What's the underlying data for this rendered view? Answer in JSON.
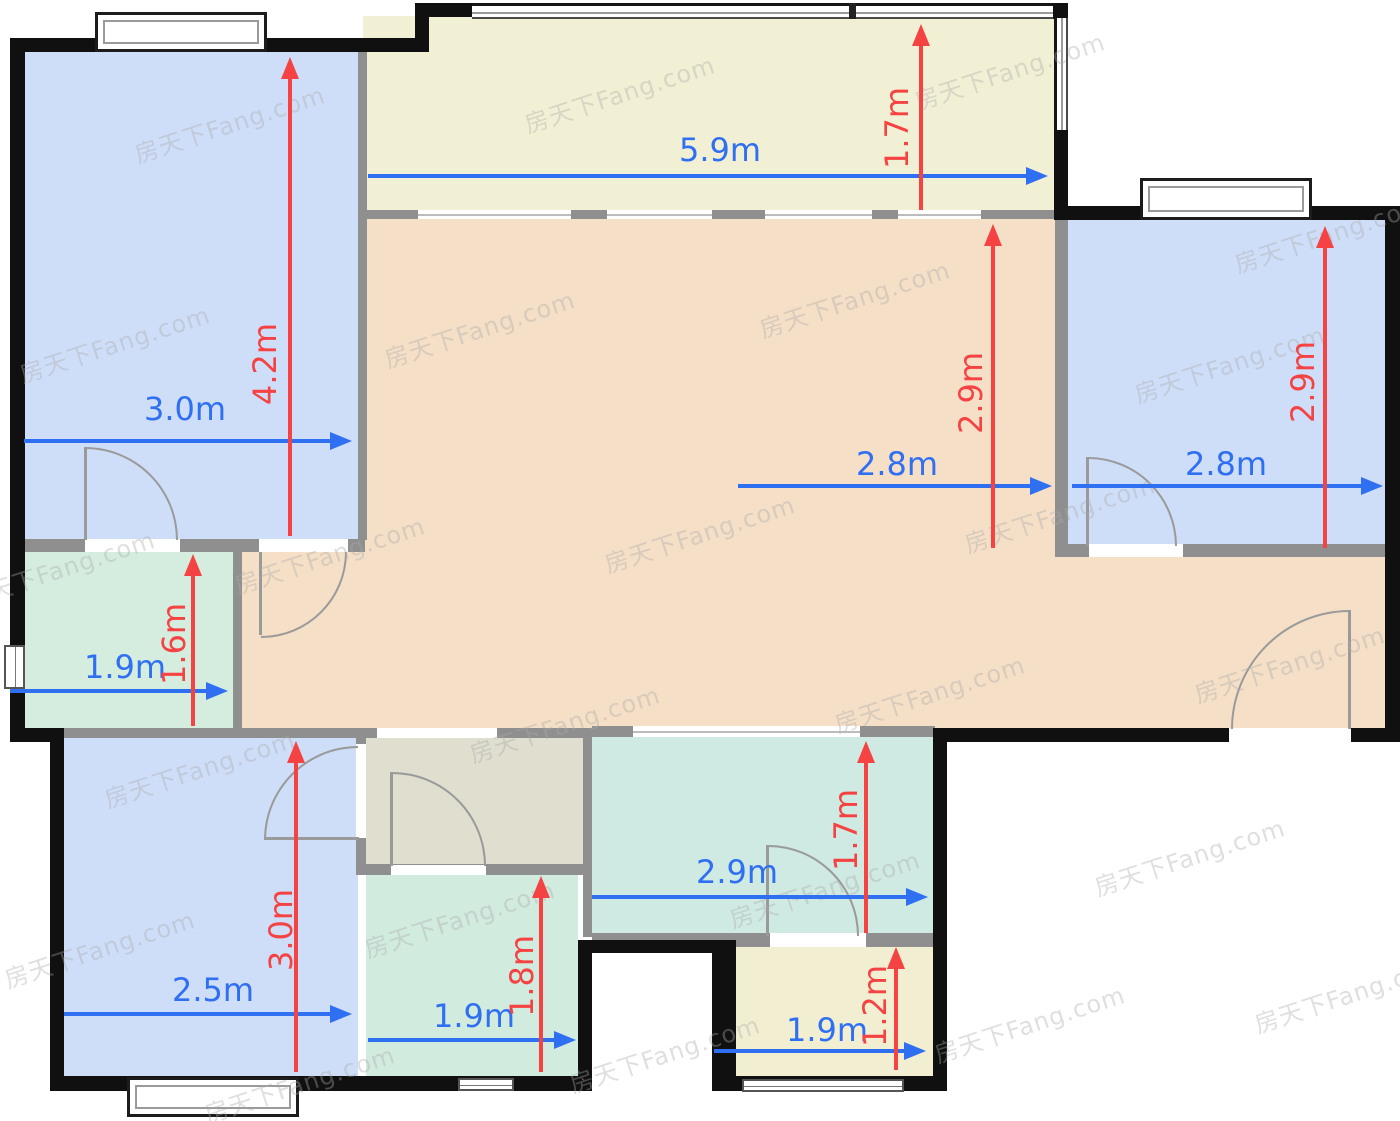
{
  "watermark": {
    "text": "房天下Fang.com"
  },
  "colors": {
    "wall_outer": "#101010",
    "wall_inner": "#8f8f8f",
    "arrow_blue": "#2f6ff2",
    "arrow_red": "#f54242",
    "door_line": "#9a9a9a",
    "room_blue": "#cfdef8",
    "room_peach": "#f5dfc7",
    "room_cream": "#f2f0d4",
    "room_cream2": "#f2eed2",
    "room_mint": "#d5eddf",
    "room_mint2": "#d2ebdf",
    "room_teal": "#cfe9e3",
    "room_olive": "#dfdecf"
  },
  "plan": {
    "rooms": [
      {
        "name": "bedroom-top-left",
        "color": "room_blue",
        "rect": [
          25,
          52,
          333,
          488
        ]
      },
      {
        "name": "balcony",
        "color": "room_cream",
        "rect": [
          363,
          16,
          692,
          196
        ]
      },
      {
        "name": "living-dining",
        "color": "room_peach",
        "rect": [
          365,
          219,
          690,
          512
        ]
      },
      {
        "name": "hall-left",
        "color": "room_peach",
        "rect": [
          242,
          552,
          123,
          181
        ]
      },
      {
        "name": "hall-entry",
        "color": "room_peach",
        "rect": [
          1055,
          557,
          331,
          175
        ]
      },
      {
        "name": "bedroom-top-right",
        "color": "room_blue",
        "rect": [
          1068,
          220,
          317,
          325
        ]
      },
      {
        "name": "utility-left",
        "color": "room_mint",
        "rect": [
          25,
          552,
          208,
          178
        ]
      },
      {
        "name": "bedroom-bottom-left",
        "color": "room_blue",
        "rect": [
          64,
          738,
          294,
          340
        ]
      },
      {
        "name": "bath-lobby",
        "color": "room_olive",
        "rect": [
          366,
          738,
          217,
          128
        ]
      },
      {
        "name": "bathroom",
        "color": "room_mint2",
        "rect": [
          366,
          873,
          212,
          205
        ]
      },
      {
        "name": "kitchen",
        "color": "room_teal",
        "rect": [
          592,
          737,
          341,
          198
        ]
      },
      {
        "name": "store-bottom",
        "color": "room_cream2",
        "rect": [
          736,
          947,
          197,
          131
        ]
      }
    ],
    "walls_inner": [
      [
        20,
        539,
        345,
        13
      ],
      [
        233,
        552,
        9,
        178
      ],
      [
        358,
        52,
        9,
        488
      ],
      [
        363,
        210,
        692,
        9
      ],
      [
        1055,
        220,
        13,
        326
      ],
      [
        1055,
        544,
        330,
        13
      ],
      [
        50,
        728,
        317,
        10
      ],
      [
        363,
        728,
        229,
        10
      ],
      [
        592,
        726,
        343,
        11
      ],
      [
        356,
        737,
        10,
        137
      ],
      [
        356,
        864,
        236,
        11
      ],
      [
        583,
        737,
        9,
        200
      ],
      [
        592,
        933,
        343,
        14
      ]
    ],
    "walls_outer": [
      [
        10,
        38,
        15,
        704
      ],
      [
        10,
        38,
        419,
        14
      ],
      [
        415,
        3,
        14,
        49
      ],
      [
        415,
        3,
        62,
        14
      ],
      [
        1051,
        3,
        17,
        16
      ],
      [
        1054,
        126,
        14,
        94
      ],
      [
        1055,
        206,
        345,
        14
      ],
      [
        1385,
        206,
        15,
        536
      ],
      [
        935,
        728,
        465,
        14
      ],
      [
        933,
        728,
        14,
        362
      ],
      [
        712,
        1076,
        235,
        15
      ],
      [
        712,
        940,
        24,
        151
      ],
      [
        578,
        940,
        158,
        13
      ],
      [
        578,
        940,
        14,
        151
      ],
      [
        358,
        1076,
        234,
        15
      ],
      [
        50,
        1076,
        320,
        15
      ],
      [
        50,
        742,
        14,
        349
      ],
      [
        10,
        728,
        54,
        14
      ]
    ],
    "openings": [
      {
        "rect": [
          85,
          539,
          95,
          13
        ]
      },
      {
        "rect": [
          259,
          539,
          89,
          13
        ]
      },
      {
        "rect": [
          377,
          728,
          120,
          10
        ]
      },
      {
        "rect": [
          391,
          865,
          95,
          10
        ]
      },
      {
        "rect": [
          356,
          744,
          10,
          94
        ]
      },
      {
        "rect": [
          633,
          726,
          227,
          11
        ],
        "line": true
      },
      {
        "rect": [
          770,
          933,
          96,
          14
        ]
      },
      {
        "rect": [
          1229,
          728,
          122,
          14
        ]
      },
      {
        "rect": [
          1089,
          544,
          94,
          13
        ]
      },
      {
        "rect": [
          418,
          210,
          153,
          9
        ],
        "line": true
      },
      {
        "rect": [
          607,
          210,
          105,
          9
        ],
        "line": true
      },
      {
        "rect": [
          765,
          210,
          107,
          9
        ],
        "line": true
      },
      {
        "rect": [
          898,
          210,
          83,
          9
        ],
        "line": true
      }
    ],
    "windows": [
      {
        "type": "framed",
        "rect": [
          95,
          12,
          172,
          40
        ]
      },
      {
        "type": "framed",
        "rect": [
          1140,
          178,
          172,
          42
        ]
      },
      {
        "type": "framed",
        "rect": [
          127,
          1077,
          172,
          40
        ]
      },
      {
        "type": "strip",
        "rect": [
          458,
          1078,
          56,
          13
        ]
      },
      {
        "type": "strip",
        "rect": [
          742,
          1079,
          162,
          13
        ]
      },
      {
        "type": "stripv",
        "rect": [
          4,
          645,
          21,
          44
        ]
      },
      {
        "type": "glassh",
        "rect": [
          472,
          3,
          581,
          16
        ]
      },
      {
        "type": "glassv",
        "rect": [
          1054,
          18,
          14,
          112
        ]
      },
      {
        "type": "mull",
        "rect": [
          849,
          3,
          7,
          16
        ]
      }
    ],
    "doors": [
      {
        "name": "door-bedroom-tl-utility",
        "leaf": [
          84,
          447,
          3,
          93
        ],
        "cx": 85,
        "cy": 540,
        "r": 93,
        "quad": "ne"
      },
      {
        "name": "door-bedroom-tl",
        "leaf": [
          259,
          552,
          3,
          83
        ],
        "cx": 261,
        "cy": 552,
        "r": 86,
        "quad": "se"
      },
      {
        "name": "door-bathroom",
        "leaf": [
          390,
          772,
          3,
          94
        ],
        "cx": 392,
        "cy": 866,
        "r": 94,
        "quad": "ne"
      },
      {
        "name": "door-bedroom-bl",
        "leaf": [
          264,
          837,
          95,
          3
        ],
        "cx": 358,
        "cy": 840,
        "r": 94,
        "quad": "nw"
      },
      {
        "name": "door-store",
        "leaf": [
          766,
          845,
          3,
          91
        ],
        "cx": 768,
        "cy": 936,
        "r": 91,
        "quad": "ne"
      },
      {
        "name": "door-entrance",
        "leaf": [
          1348,
          610,
          3,
          119
        ],
        "cx": 1350,
        "cy": 729,
        "r": 119,
        "quad": "nw"
      },
      {
        "name": "door-bedroom-tr",
        "leaf": [
          1086,
          457,
          3,
          89
        ],
        "cx": 1088,
        "cy": 546,
        "r": 89,
        "quad": "ne"
      }
    ],
    "dims_h": [
      {
        "label": "3.0m",
        "x1": 24,
        "x2": 352,
        "y": 441,
        "lx": 185,
        "ly": 409
      },
      {
        "label": "5.9m",
        "x1": 368,
        "x2": 1048,
        "y": 176,
        "lx": 720,
        "ly": 150
      },
      {
        "label": "2.8m",
        "x1": 738,
        "x2": 1052,
        "y": 486,
        "lx": 897,
        "ly": 464
      },
      {
        "label": "2.8m",
        "x1": 1072,
        "x2": 1383,
        "y": 486,
        "lx": 1226,
        "ly": 464
      },
      {
        "label": "1.9m",
        "x1": 10,
        "x2": 228,
        "y": 691,
        "lx": 125,
        "ly": 667
      },
      {
        "label": "2.5m",
        "x1": 64,
        "x2": 352,
        "y": 1014,
        "lx": 213,
        "ly": 990
      },
      {
        "label": "1.9m",
        "x1": 368,
        "x2": 576,
        "y": 1040,
        "lx": 474,
        "ly": 1016
      },
      {
        "label": "2.9m",
        "x1": 592,
        "x2": 928,
        "y": 897,
        "lx": 737,
        "ly": 872
      },
      {
        "label": "1.9m",
        "x1": 714,
        "x2": 926,
        "y": 1051,
        "lx": 827,
        "ly": 1030
      }
    ],
    "dims_v": [
      {
        "label": "4.2m",
        "x": 290,
        "y1": 57,
        "y2": 536,
        "lx": 265,
        "ly": 364
      },
      {
        "label": "1.7m",
        "x": 921,
        "y1": 24,
        "y2": 210,
        "lx": 897,
        "ly": 128
      },
      {
        "label": "2.9m",
        "x": 993,
        "y1": 224,
        "y2": 548,
        "lx": 971,
        "ly": 393
      },
      {
        "label": "2.9m",
        "x": 1325,
        "y1": 226,
        "y2": 548,
        "lx": 1303,
        "ly": 382
      },
      {
        "label": "1.6m",
        "x": 193,
        "y1": 554,
        "y2": 726,
        "lx": 174,
        "ly": 644
      },
      {
        "label": "3.0m",
        "x": 296,
        "y1": 741,
        "y2": 1072,
        "lx": 281,
        "ly": 930
      },
      {
        "label": "1.8m",
        "x": 541,
        "y1": 876,
        "y2": 1072,
        "lx": 522,
        "ly": 976
      },
      {
        "label": "1.7m",
        "x": 866,
        "y1": 741,
        "y2": 933,
        "lx": 846,
        "ly": 830
      },
      {
        "label": "1.2m",
        "x": 896,
        "y1": 947,
        "y2": 1070,
        "lx": 875,
        "ly": 1006
      }
    ],
    "watermarks": [
      [
        230,
        125
      ],
      [
        620,
        95
      ],
      [
        1010,
        72
      ],
      [
        1330,
        235
      ],
      [
        115,
        345
      ],
      [
        480,
        330
      ],
      [
        855,
        300
      ],
      [
        1230,
        365
      ],
      [
        60,
        570
      ],
      [
        330,
        556
      ],
      [
        700,
        535
      ],
      [
        1060,
        515
      ],
      [
        200,
        770
      ],
      [
        565,
        725
      ],
      [
        930,
        695
      ],
      [
        1290,
        665
      ],
      [
        100,
        950
      ],
      [
        460,
        920
      ],
      [
        825,
        890
      ],
      [
        1190,
        858
      ],
      [
        300,
        1085
      ],
      [
        665,
        1055
      ],
      [
        1030,
        1025
      ],
      [
        1350,
        995
      ]
    ]
  }
}
